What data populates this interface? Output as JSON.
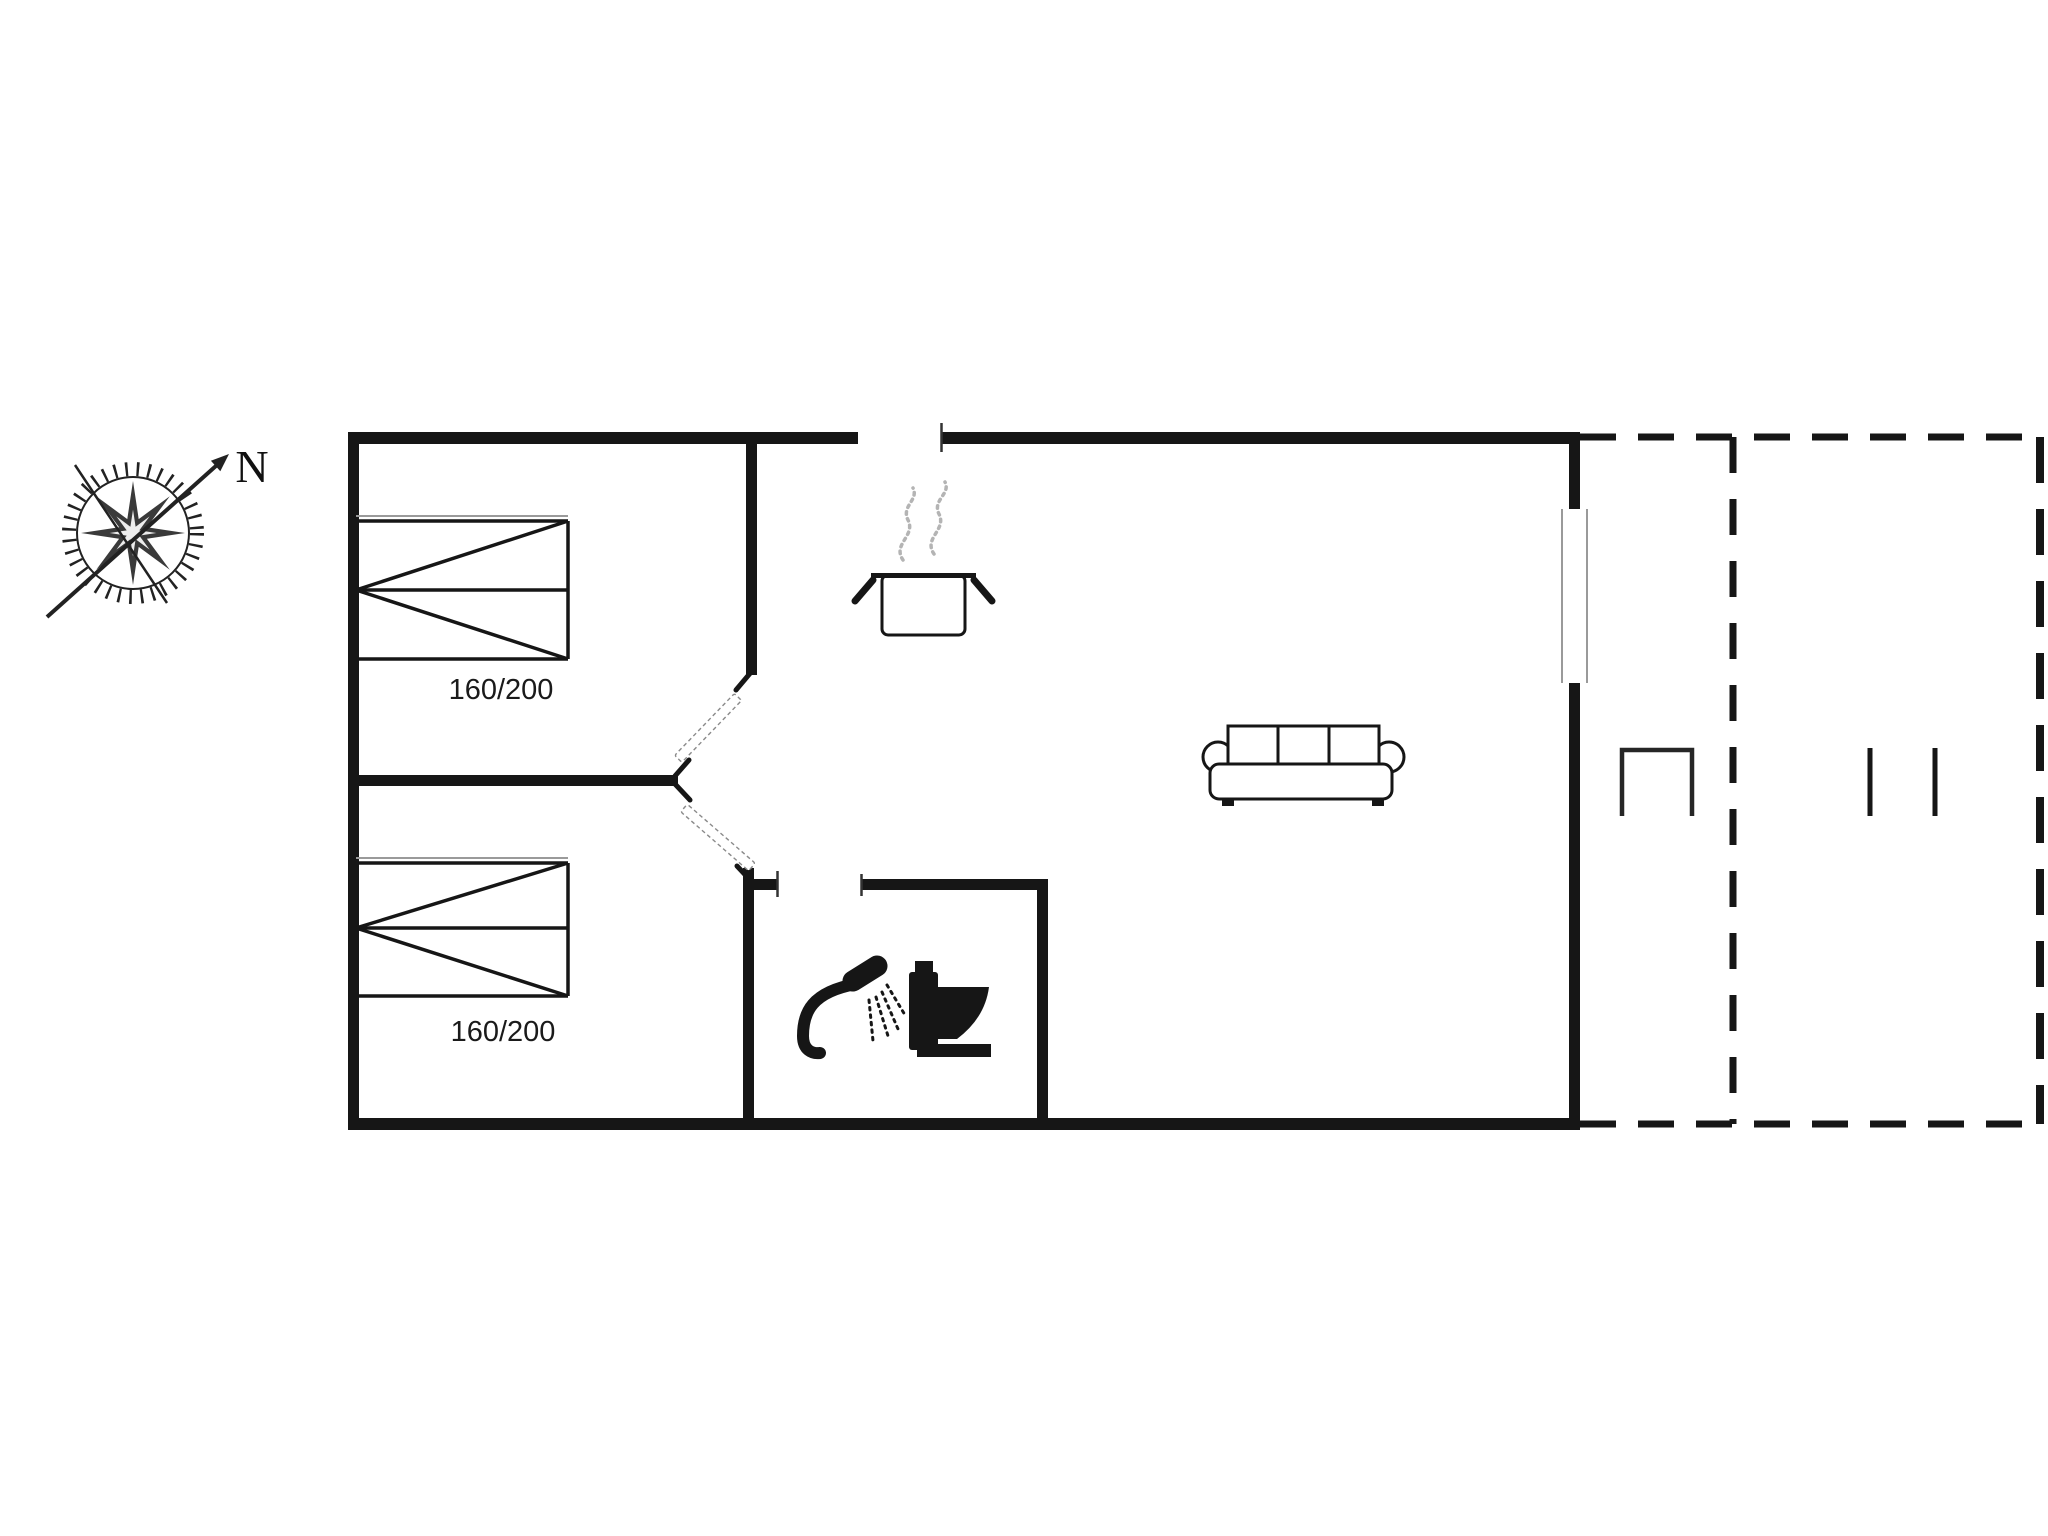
{
  "compass": {
    "north_label": "N"
  },
  "bedrooms": [
    {
      "name": "bedroom-1",
      "bed_label": "160/200",
      "bed_type": "double-bed"
    },
    {
      "name": "bedroom-2",
      "bed_label": "160/200",
      "bed_type": "double-bed"
    }
  ],
  "fixtures": {
    "kitchen": "cooking-pot-with-steam",
    "bathroom": [
      "shower-head",
      "toilet"
    ],
    "living_room": "sofa",
    "terrace": [
      "terrace-furniture",
      "terrace-post-markers"
    ]
  },
  "icons": [
    "compass-rose-icon",
    "double-bed-icon",
    "cooking-pot-icon",
    "steam-icon",
    "shower-icon",
    "toilet-icon",
    "sofa-icon",
    "window-marker",
    "door-leaf",
    "terrace-furniture-icon",
    "terrace-post-markers"
  ],
  "colors": {
    "ink": "#161616",
    "steam": "#b4b4b4",
    "accent": "#9a9a9a",
    "leaf": "#8a8a8a",
    "background": "#ffffff"
  }
}
